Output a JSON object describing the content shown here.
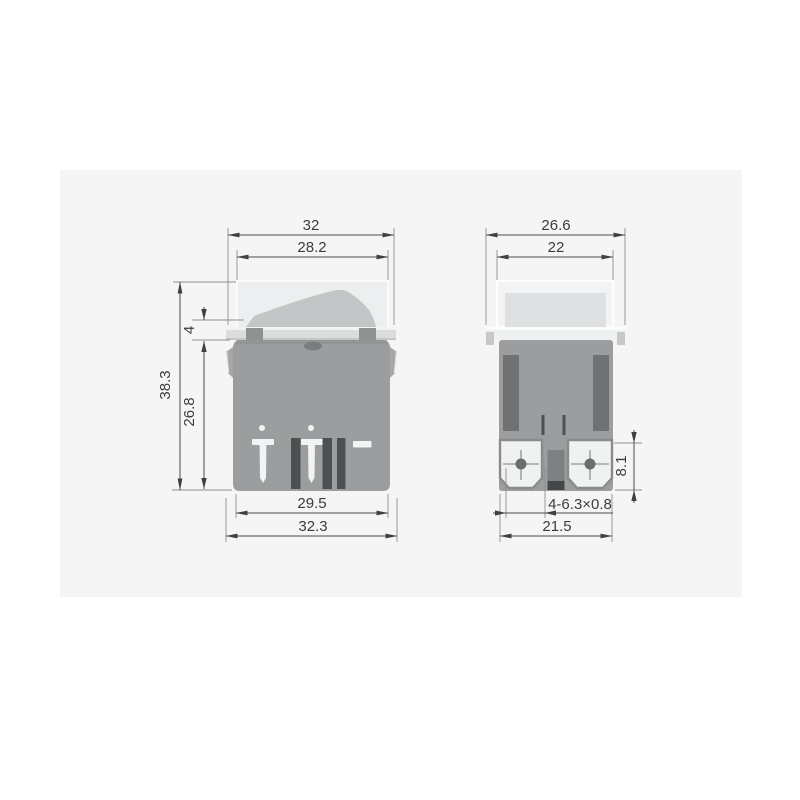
{
  "drawing": {
    "type": "rocker-switch-dimension-drawing",
    "views": [
      "front",
      "side"
    ]
  },
  "dims": {
    "front_overall_width": "32",
    "front_cover_width": "28.2",
    "front_overall_height": "38.3",
    "front_body_height": "26.8",
    "front_bezel_height": "4",
    "front_body_bottom_width": "29.5",
    "front_flange_width": "32.3",
    "side_overall_depth": "26.6",
    "side_cover_depth": "22",
    "side_terminal_height": "8.1",
    "side_terminal_spec": "4-6.3×0.8",
    "side_bottom_depth": "21.5"
  },
  "colors": {
    "panel_bg": "#f5f5f6",
    "page_bg": "#ffffff",
    "body": "#9b9d9e",
    "slot": "#6f7173",
    "cover_front": "#eceeef",
    "cover_side": "#f2f3f4",
    "cover_inner": "#dee0e1",
    "bezel": "#dbdddd",
    "rocker": "#c3c5c6",
    "hinge_tab": "#8e9092",
    "terminal_face": "#f0f1f1",
    "terminal_border": "#898b8d",
    "screw_dot": "#6b6d6f",
    "dim_line": "#4b4c4e"
  }
}
